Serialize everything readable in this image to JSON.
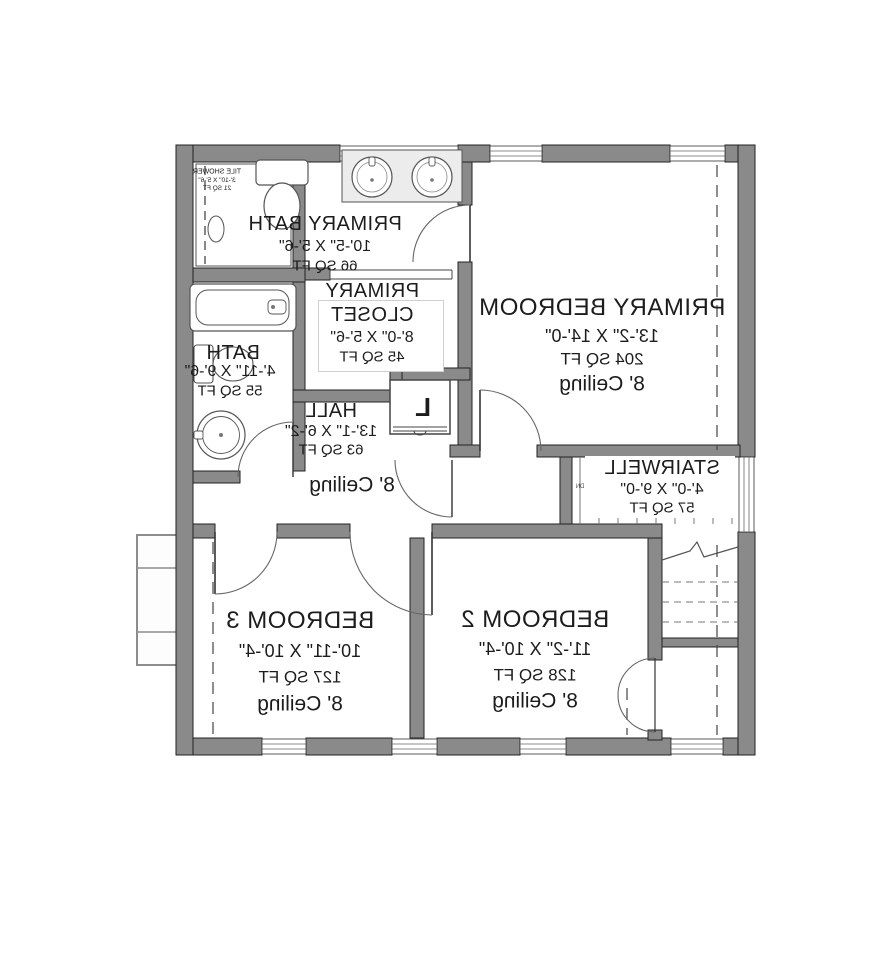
{
  "plan": {
    "type": "floor-plan",
    "mirrored_text": true,
    "rooms": {
      "tile_shower": {
        "name": "TILE SHOWER",
        "dims": "3'-10\" X 5'-6\"",
        "area": "21 SQ FT"
      },
      "primary_bath": {
        "name": "PRIMARY BATH",
        "dims": "10'-5\" X 5'-6\"",
        "area": "66 SQ FT"
      },
      "primary_closet": {
        "name_line1": "PRIMARY",
        "name_line2": "CLOSET",
        "dims": "8'-0\" X 5'-6\"",
        "area": "45 SQ FT"
      },
      "primary_bedroom": {
        "name": "PRIMARY BEDROOM",
        "dims": "13'-2\" X 14'-0\"",
        "area": "204 SQ FT",
        "ceiling": "8' Ceiling"
      },
      "bath": {
        "name": "BATH",
        "dims": "4'-11\" X 9'-6\"",
        "area": "55 SQ FT"
      },
      "hall": {
        "name": "HALL",
        "dims": "13'-1\" X 6'-2\"",
        "area": "63 SQ FT",
        "ceiling": "8' Ceiling"
      },
      "stairwell": {
        "name": "STAIRWELL",
        "dims": "4'-0\" X 9'-0\"",
        "area": "57 SQ FT",
        "direction": "DN"
      },
      "bedroom_2": {
        "name": "BEDROOM 2",
        "dims": "11'-2\" X 10'-4\"",
        "area": "128 SQ FT",
        "ceiling": "8' Ceiling"
      },
      "bedroom_3": {
        "name": "BEDROOM 3",
        "dims": "10'-11\" X 10'-4\"",
        "area": "127 SQ FT",
        "ceiling": "8' Ceiling"
      },
      "linen_closet": {
        "label": "L"
      }
    },
    "colors": {
      "wall_fill": "#8a8a8a",
      "wall_outline": "#222222",
      "background": "#ffffff",
      "fixture_line": "#555555",
      "text": "#1c1c1c"
    }
  }
}
